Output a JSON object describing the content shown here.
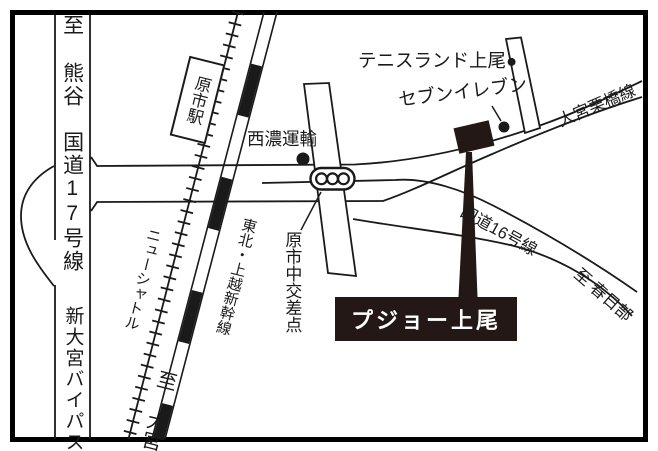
{
  "colors": {
    "ink": "#1a1a1a",
    "accent_black": "#231815",
    "road_fill": "#ffffff",
    "label_text": "#ffffff"
  },
  "roads": {
    "route17_label": "至 熊谷　国道17号線",
    "bypass_label": "新大宮バイパス",
    "kurihashi_label": "大宮栗橋線",
    "route16_label": "国道16号線",
    "kasukabe_label": "至 春日部"
  },
  "railways": {
    "new_shuttle_label": "ニューシャトル",
    "shinkansen_label": "東北・上越新幹線",
    "station_label": "原市駅",
    "to_omiya_label": "至 大宮"
  },
  "landmarks": {
    "tennis_label": "テニスランド上尾●",
    "seven_label": "セブンイレブン",
    "seino_label": "西濃運輸",
    "intersection_label": "原市中交差点",
    "destination_label": "プジョー上尾"
  }
}
